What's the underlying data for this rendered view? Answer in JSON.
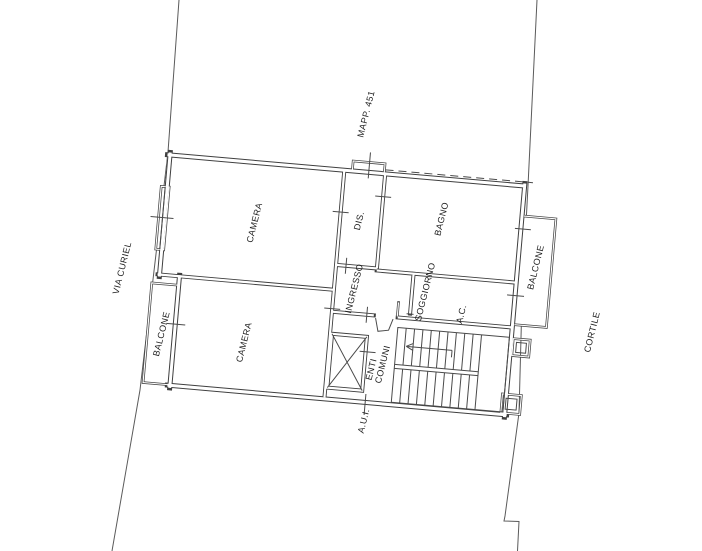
{
  "plan": {
    "exterior_labels": {
      "street": "VIA CURIEL",
      "parcel": "MAPP. 451",
      "courtyard": "CORTILE"
    },
    "rooms": {
      "camera_1": "CAMERA",
      "camera_2": "CAMERA",
      "balcone_left": "BALCONE",
      "balcone_right": "BALCONE",
      "dis": "DIS.",
      "bagno": "BAGNO",
      "ingresso": "INGRESSO",
      "soggiorno": "SOGGIORNO",
      "ac": "A.C.",
      "enti_comuni_line_1": "ENTI",
      "enti_comuni_line_2": "COMUNI",
      "aui": "A.U.I."
    },
    "colors": {
      "background": "#ffffff",
      "line": "#4a4a4a",
      "text": "#1f1f1f"
    }
  }
}
